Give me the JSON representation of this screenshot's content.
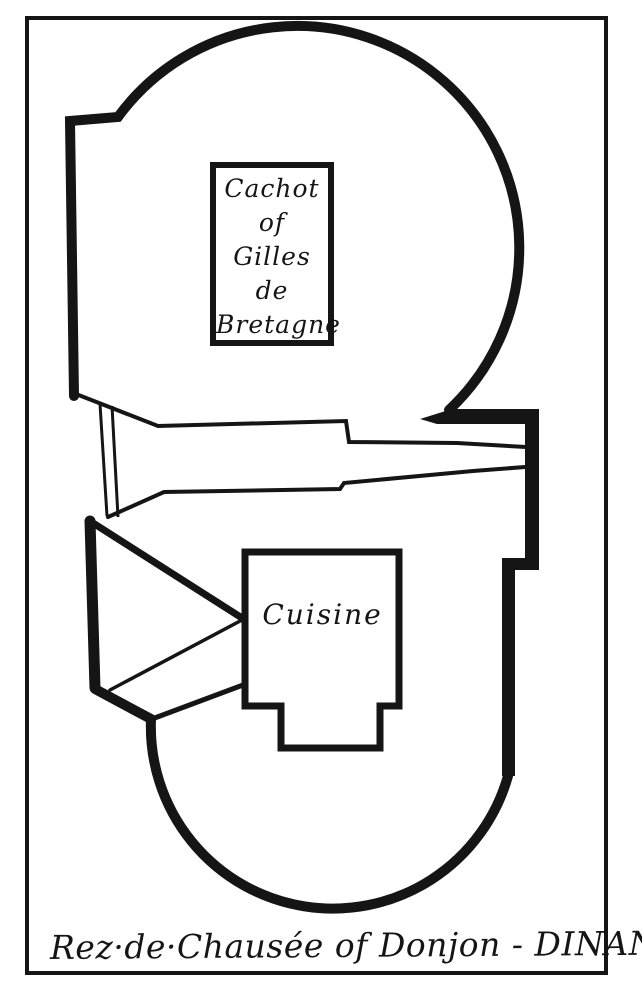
{
  "figure": {
    "kind": "hand-drawn architectural floor plan",
    "caption": "Rez·de·Chausée of Donjon - DINAN",
    "rooms": {
      "cachot": {
        "lines": [
          "Cachot",
          "of",
          "Gilles",
          "de",
          "Bretagne"
        ]
      },
      "cuisine": {
        "label": "Cuisine"
      }
    },
    "colors": {
      "ink": "#151515",
      "paper": "#ffffff"
    }
  }
}
